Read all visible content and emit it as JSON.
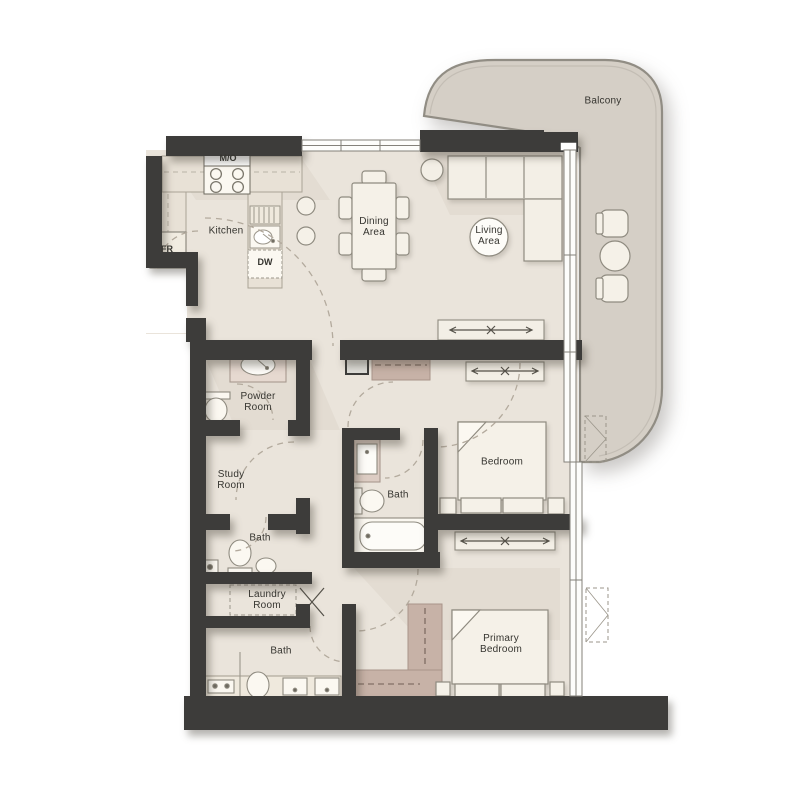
{
  "plan": {
    "type": "apartment-floor-plan",
    "rooms": {
      "balcony": {
        "label": "Balcony"
      },
      "kitchen": {
        "label": "Kitchen"
      },
      "dining": {
        "label": "Dining\nArea"
      },
      "living": {
        "label": "Living\nArea"
      },
      "powder": {
        "label": "Powder\nRoom"
      },
      "study": {
        "label": "Study\nRoom"
      },
      "bath_small": {
        "label": "Bath"
      },
      "laundry": {
        "label": "Laundry\nRoom"
      },
      "bath_middle": {
        "label": "Bath"
      },
      "bath_primary": {
        "label": "Bath"
      },
      "bedroom": {
        "label": "Bedroom"
      },
      "primary_bedroom": {
        "label": "Primary\nBedroom"
      }
    },
    "appliances": {
      "microwave_oven": {
        "label": "M/O"
      },
      "fridge": {
        "label": "FR"
      },
      "dishwasher": {
        "label": "DW"
      }
    },
    "colors": {
      "wall": "#3d3c3a",
      "floor": "#eae4db",
      "balcony_floor": "#d5cfc6",
      "furniture": "#f5f1e8",
      "counter": "#e8e1d6",
      "closet": "#c7b2a7",
      "outline": "#97938a",
      "dash": "#b3aa9d"
    }
  }
}
